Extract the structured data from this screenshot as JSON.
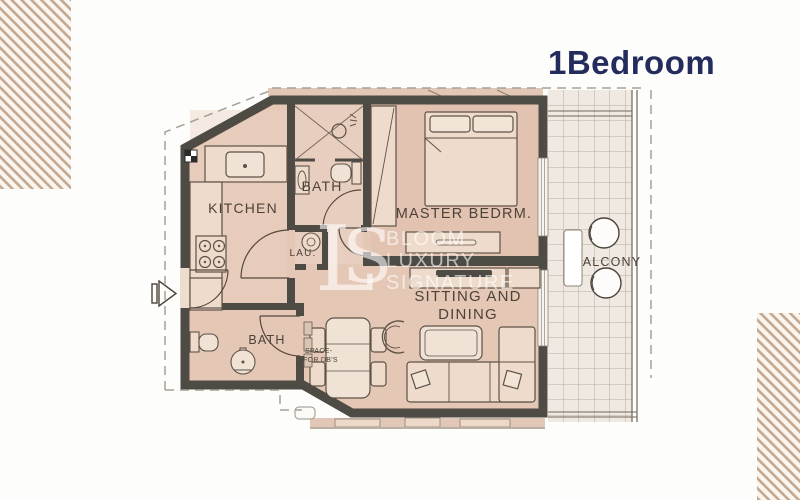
{
  "title": "1Bedroom",
  "floor_plan": {
    "rooms": {
      "kitchen": "KITCHEN",
      "bath": "BATH",
      "laundry": "LAU.",
      "master_bedroom": "MASTER BEDRM.",
      "sitting_dining_line1": "SITTING AND",
      "sitting_dining_line2": "DINING",
      "bath2": "BATH",
      "balcony": "ALCONY",
      "db_space_line1": "SPACE-",
      "db_space_line2": "FOR DB'S"
    }
  },
  "watermark": {
    "monogram_l": "L",
    "monogram_s": "S",
    "line1": "BLOOM",
    "line2": "LUXURY",
    "line3": "SIGNATURE"
  },
  "colors": {
    "title_navy": "#242c5d",
    "wall": "#4e4a44",
    "room_fill": "#e5c7b6",
    "balcony_tile": "#efe9e2",
    "hatch_stripe": "#c3a88f"
  }
}
